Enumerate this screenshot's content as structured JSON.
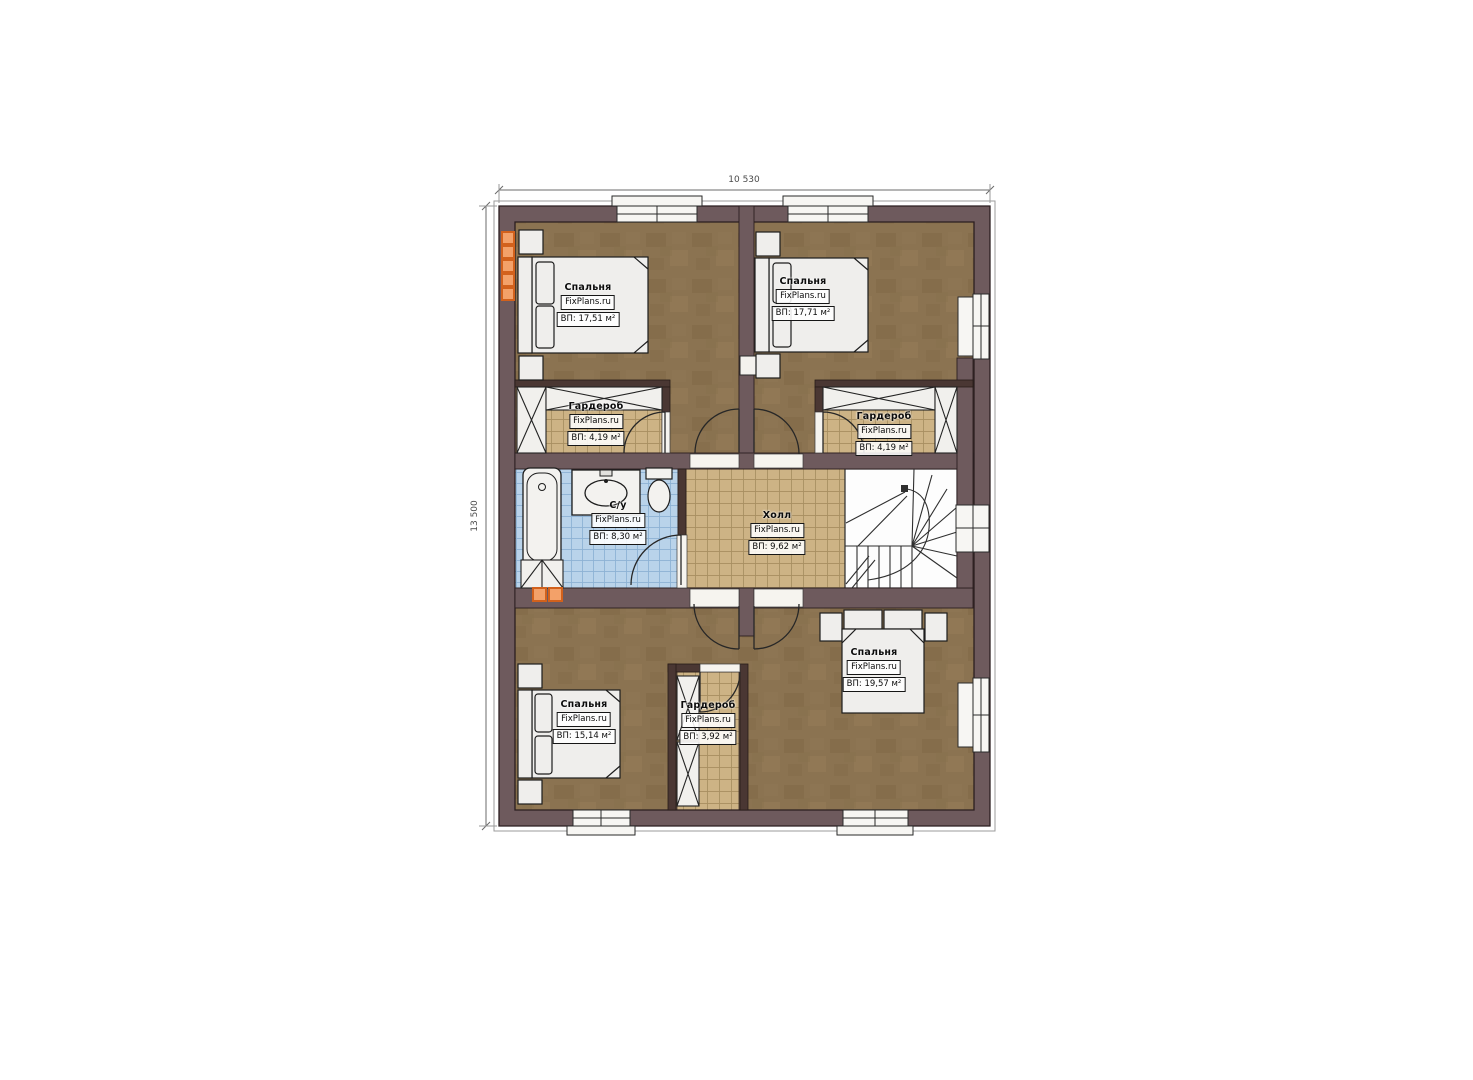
{
  "plan": {
    "source_watermark": "FixPlans.ru",
    "dimensions": {
      "top_label": "10 530",
      "left_label": "13 500"
    }
  },
  "rooms": [
    {
      "id": "bedroom-top-left",
      "name": "Спальня",
      "watermark": "FixPlans.ru",
      "area": "ВП: 17,51 м²"
    },
    {
      "id": "bedroom-top-right",
      "name": "Спальня",
      "watermark": "FixPlans.ru",
      "area": "ВП: 17,71 м²"
    },
    {
      "id": "wardrobe-left",
      "name": "Гардероб",
      "watermark": "FixPlans.ru",
      "area": "ВП: 4,19 м²"
    },
    {
      "id": "wardrobe-right",
      "name": "Гардероб",
      "watermark": "FixPlans.ru",
      "area": "ВП: 4,19 м²"
    },
    {
      "id": "bathroom",
      "name": "С/у",
      "watermark": "FixPlans.ru",
      "area": "ВП: 8,30 м²"
    },
    {
      "id": "hall",
      "name": "Холл",
      "watermark": "FixPlans.ru",
      "area": "ВП: 9,62 м²"
    },
    {
      "id": "bedroom-bottom-left",
      "name": "Спальня",
      "watermark": "FixPlans.ru",
      "area": "ВП: 15,14 м²"
    },
    {
      "id": "wardrobe-bottom",
      "name": "Гардероб",
      "watermark": "FixPlans.ru",
      "area": "ВП: 3,92 м²"
    },
    {
      "id": "bedroom-bottom-right",
      "name": "Спальня",
      "watermark": "FixPlans.ru",
      "area": "ВП: 19,57 м²"
    }
  ],
  "colors": {
    "exterior_wall": "#6e5a5d",
    "partition_wall": "#4a3733",
    "bedroom_floor": "#8b7351",
    "tile_floor": "#cdb385",
    "bath_tile": "#b9d3ea",
    "accent_orange": "#f3a169",
    "line_dark": "#2b1e20"
  }
}
